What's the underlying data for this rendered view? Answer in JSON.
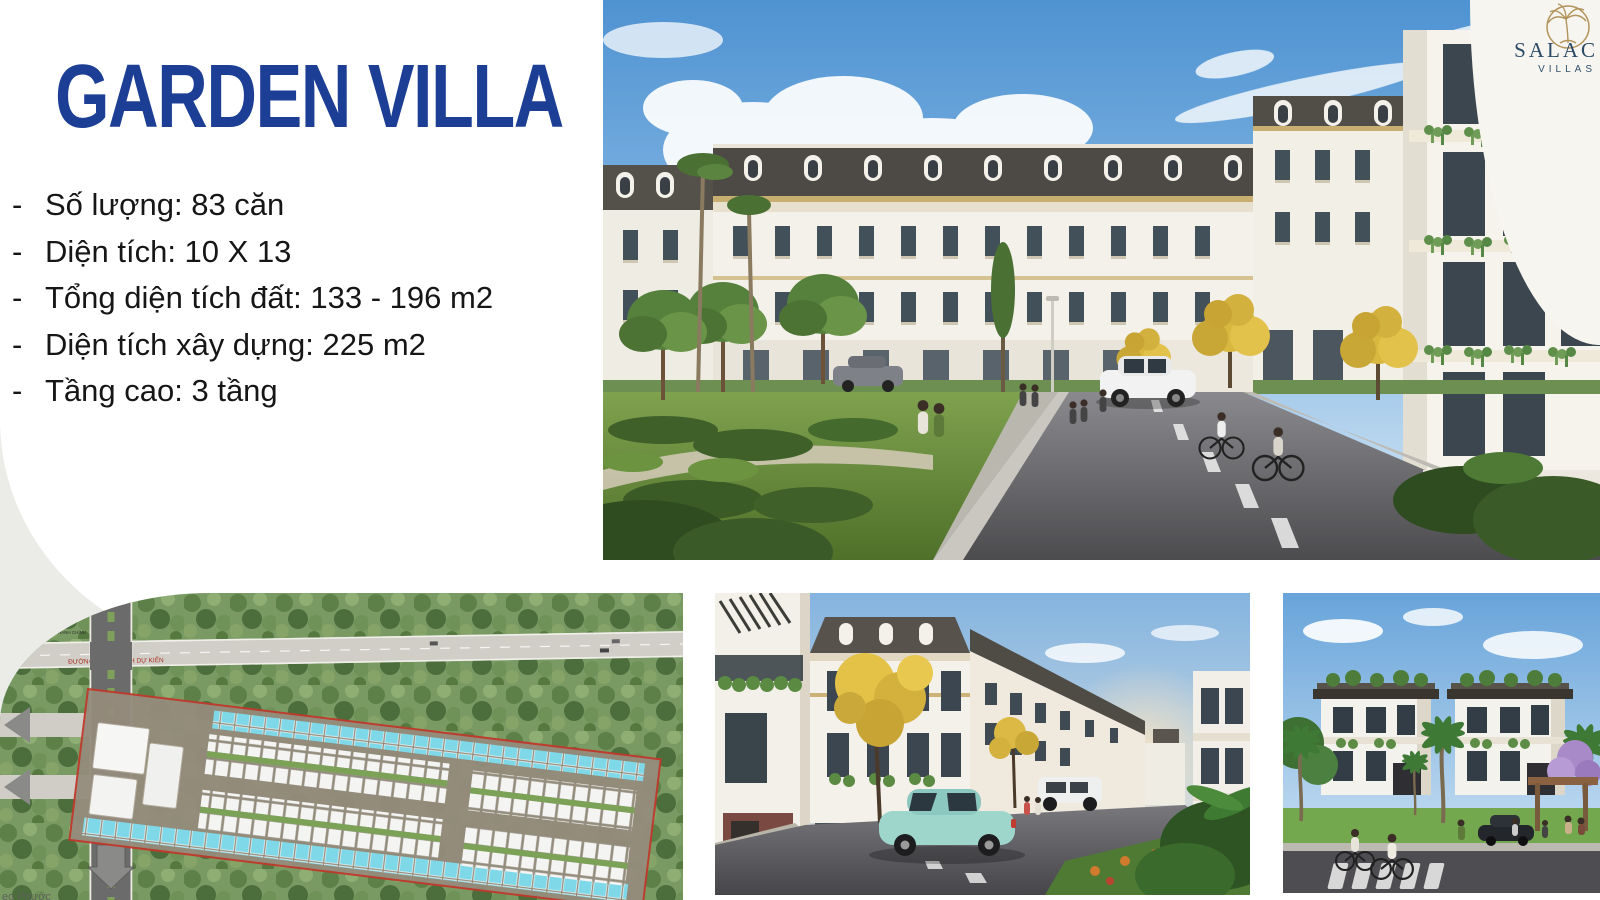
{
  "slide": {
    "title": "GARDEN VILLA",
    "title_color": "#1c3e94"
  },
  "specs": {
    "marker": "-",
    "items": [
      "Số lượng: 83 căn",
      "Diện tích: 10 X 13",
      "Tổng diện tích đất: 133 - 196 m2",
      "Diện tích xây dựng: 225 m2",
      "Tầng cao: 3 tầng"
    ]
  },
  "brand": {
    "name": "SALAC",
    "subtitle": "VILLAS",
    "icon": "palm-tree-icon",
    "gold": "#b2945c",
    "navy": "#2b4a66"
  },
  "site_plan": {
    "road_label": "ĐƯỜNG QUY HOẠCH DỰ KIẾN",
    "center_label": "TRUNG TÂM HÀNH CHÍNH",
    "watermark_fragment": "eo Phước",
    "boundary_color": "#c0392b",
    "unit_highlight_color": "#7fd8e8"
  },
  "images": {
    "hero_alt": "street-render-of-classic-garden-villas",
    "siteplan_alt": "aerial-master-plan",
    "mid_alt": "street-render-with-teal-car",
    "right_alt": "two-modern-villas-with-palms"
  }
}
